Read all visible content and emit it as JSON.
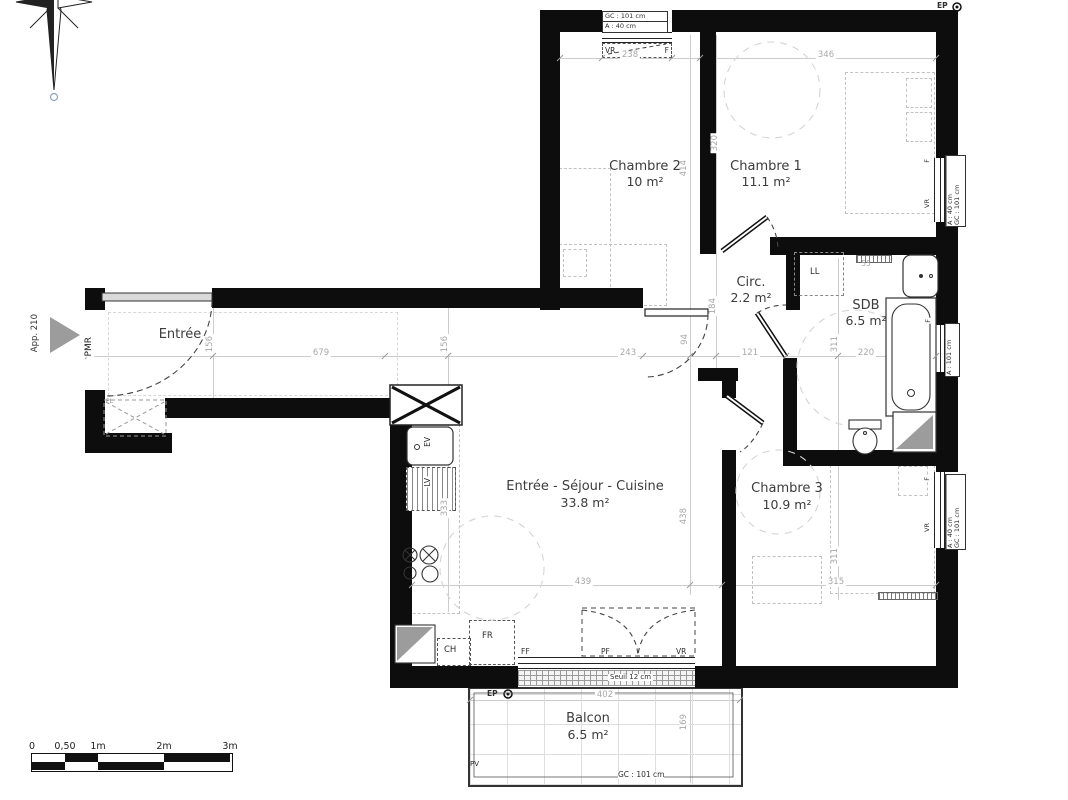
{
  "apartment": {
    "label": "App. 210",
    "pmr": "PMR"
  },
  "rooms": [
    {
      "name": "Chambre 2",
      "area": "10 m²"
    },
    {
      "name": "Chambre 1",
      "area": "11.1 m²"
    },
    {
      "name": "Circ.",
      "area": "2.2 m²"
    },
    {
      "name": "SDB",
      "area": "6.5 m²"
    },
    {
      "name": "Entrée"
    },
    {
      "name": "Entrée - Séjour - Cuisine",
      "area": "33.8 m²"
    },
    {
      "name": "Chambre 3",
      "area": "10.9 m²"
    },
    {
      "name": "Balcon",
      "area": "6.5 m²"
    }
  ],
  "equipment": {
    "ll": "LL",
    "ev": "EV",
    "lv": "LV",
    "fr": "FR",
    "ch": "CH",
    "pl": "PL"
  },
  "openings": {
    "ch2_top": {
      "gc": "GC : 101 cm",
      "a": "A : 40 cm",
      "vr": "VR",
      "f": "F"
    },
    "ch1_right": {
      "a": "A : 40 cm",
      "gc": "GC : 101 cm",
      "vr": "VR",
      "f": "F"
    },
    "sdb_right": {
      "a": "A : 101 cm",
      "f": "F"
    },
    "ch3_right": {
      "a": "A : 40 cm",
      "gc": "GC : 101 cm",
      "vr": "VR",
      "f": "F"
    },
    "bottom": {
      "ff": "FF",
      "pf": "PF",
      "vr": "VR",
      "seuil": "Seuil 12 cm"
    },
    "balcon": {
      "gc": "GC : 101 cm",
      "pv": "PV",
      "ep": "EP"
    },
    "ep_top": "EP"
  },
  "dims": {
    "d238": "238",
    "d346": "346",
    "d320": "320",
    "d414": "414",
    "d184": "184",
    "d94": "94",
    "d243": "243",
    "d121": "121",
    "d220": "220",
    "d311_sdb": "311",
    "d156_entree": "156",
    "d156_sejour": "156",
    "d679": "679",
    "d333": "333",
    "d438": "438",
    "d439": "439",
    "d311_ch3": "311",
    "d315": "315",
    "d402": "402",
    "d169": "169",
    "d55": "55"
  },
  "scalebar": {
    "t0": "0",
    "t05": "0,50",
    "t1": "1m",
    "t2": "2m",
    "t3": "3m"
  },
  "colors": {
    "wall": "#0d0d0d",
    "dim_text": "#a8a8a8",
    "gray_fill": "#9c9c9c"
  }
}
